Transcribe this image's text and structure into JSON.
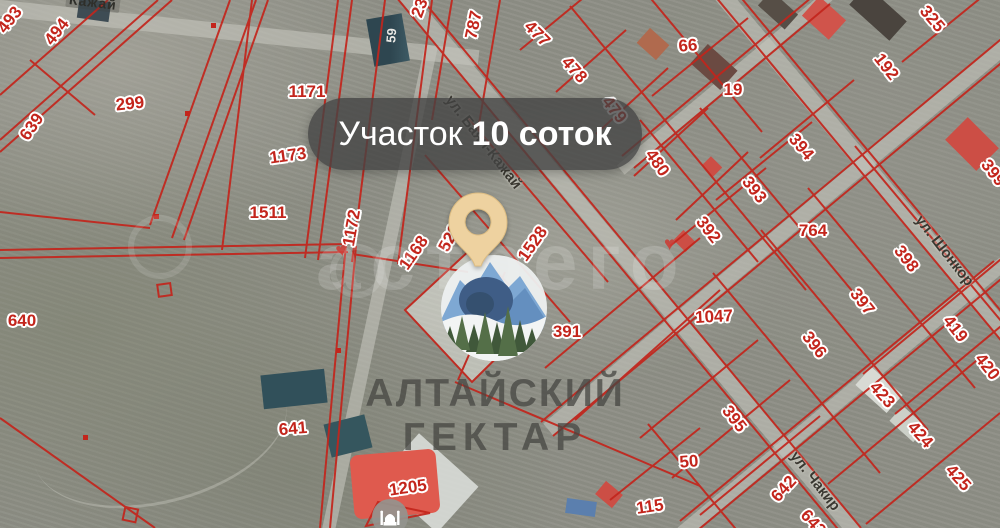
{
  "pin_label": {
    "prefix": "Участок",
    "bold": "10 соток"
  },
  "brand": {
    "line1": "АЛТАЙСКИЙ",
    "line2": "ГЕКТАР"
  },
  "watermark_text": "астрего",
  "streets": {
    "bayan_kazhay": "ул. Баян-Кажай",
    "shonkor": "ул. Шонкор",
    "chakir": "ул. Чакир",
    "top_edge": "Кажай"
  },
  "building_label": "59",
  "poi": {
    "mosque": "mosque-icon"
  },
  "colors": {
    "parcel_line": "#c3251c",
    "pin": "#eed2a0",
    "pill_bg": "rgba(66,66,66,0.78)",
    "logo_mountain": "#7ea8d3",
    "logo_tree": "#40583a",
    "heart": "#ce3a32"
  },
  "parcels": [
    {
      "num": "493",
      "x": 10,
      "y": 20,
      "rot": -52
    },
    {
      "num": "494",
      "x": 57,
      "y": 32,
      "rot": -52
    },
    {
      "num": "299",
      "x": 130,
      "y": 104,
      "rot": -6
    },
    {
      "num": "639",
      "x": 32,
      "y": 127,
      "rot": -55
    },
    {
      "num": "1171",
      "x": 307,
      "y": 92,
      "rot": 0
    },
    {
      "num": "1173",
      "x": 288,
      "y": 156,
      "rot": -8
    },
    {
      "num": "1511",
      "x": 268,
      "y": 213,
      "rot": 0
    },
    {
      "num": "1172",
      "x": 352,
      "y": 228,
      "rot": -80
    },
    {
      "num": "1168",
      "x": 414,
      "y": 253,
      "rot": -55
    },
    {
      "num": "529",
      "x": 450,
      "y": 238,
      "rot": -62
    },
    {
      "num": "787",
      "x": 474,
      "y": 25,
      "rot": -78
    },
    {
      "num": "23",
      "x": 420,
      "y": 8,
      "rot": -70
    },
    {
      "num": "477",
      "x": 537,
      "y": 34,
      "rot": 45
    },
    {
      "num": "478",
      "x": 574,
      "y": 70,
      "rot": 48
    },
    {
      "num": "479",
      "x": 614,
      "y": 110,
      "rot": 52
    },
    {
      "num": "480",
      "x": 657,
      "y": 163,
      "rot": 55
    },
    {
      "num": "66",
      "x": 688,
      "y": 46,
      "rot": -5
    },
    {
      "num": "19",
      "x": 733,
      "y": 90,
      "rot": 0
    },
    {
      "num": "325",
      "x": 932,
      "y": 19,
      "rot": 50
    },
    {
      "num": "192",
      "x": 886,
      "y": 67,
      "rot": 52
    },
    {
      "num": "394",
      "x": 801,
      "y": 147,
      "rot": 50
    },
    {
      "num": "393",
      "x": 754,
      "y": 190,
      "rot": 52
    },
    {
      "num": "392",
      "x": 708,
      "y": 230,
      "rot": 52
    },
    {
      "num": "764",
      "x": 813,
      "y": 231,
      "rot": 0
    },
    {
      "num": "399",
      "x": 993,
      "y": 173,
      "rot": 52
    },
    {
      "num": "398",
      "x": 906,
      "y": 259,
      "rot": 52
    },
    {
      "num": "397",
      "x": 862,
      "y": 302,
      "rot": 52
    },
    {
      "num": "396",
      "x": 814,
      "y": 345,
      "rot": 52
    },
    {
      "num": "419",
      "x": 955,
      "y": 329,
      "rot": 52
    },
    {
      "num": "420",
      "x": 987,
      "y": 367,
      "rot": 52
    },
    {
      "num": "1047",
      "x": 714,
      "y": 317,
      "rot": -3
    },
    {
      "num": "391",
      "x": 567,
      "y": 332,
      "rot": 0
    },
    {
      "num": "1528",
      "x": 533,
      "y": 244,
      "rot": -55
    },
    {
      "num": "640",
      "x": 22,
      "y": 321,
      "rot": 0
    },
    {
      "num": "641",
      "x": 293,
      "y": 429,
      "rot": -5
    },
    {
      "num": "1205",
      "x": 408,
      "y": 488,
      "rot": -8
    },
    {
      "num": "395",
      "x": 734,
      "y": 419,
      "rot": 52
    },
    {
      "num": "423",
      "x": 882,
      "y": 395,
      "rot": 48
    },
    {
      "num": "424",
      "x": 920,
      "y": 435,
      "rot": 48
    },
    {
      "num": "425",
      "x": 958,
      "y": 478,
      "rot": 48
    },
    {
      "num": "642",
      "x": 784,
      "y": 489,
      "rot": -48
    },
    {
      "num": "50",
      "x": 689,
      "y": 462,
      "rot": -5
    },
    {
      "num": "115",
      "x": 650,
      "y": 507,
      "rot": -8
    },
    {
      "num": "643",
      "x": 813,
      "y": 523,
      "rot": 48
    }
  ]
}
